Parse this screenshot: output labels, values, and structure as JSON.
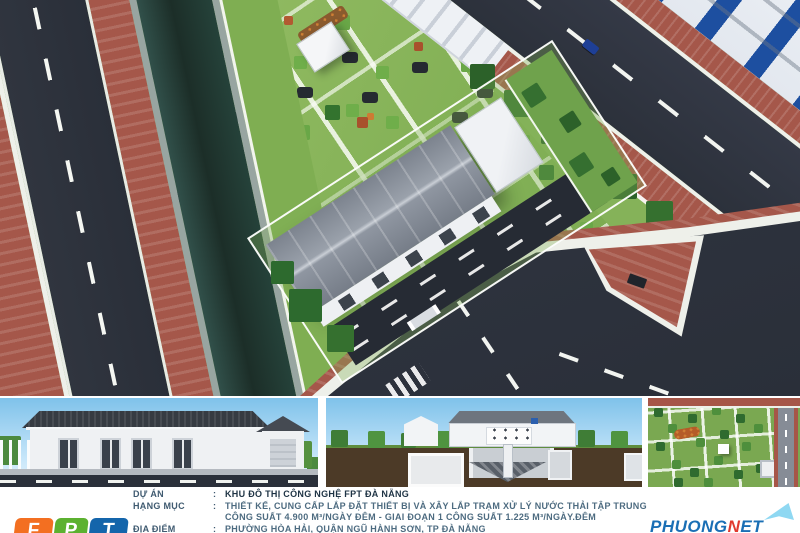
{
  "info": {
    "rows": [
      {
        "label": "DỰ ÁN",
        "colon": ":",
        "value": "KHU ĐÔ THỊ CÔNG NGHỆ FPT ĐÀ NẴNG"
      },
      {
        "label": "HẠNG MỤC",
        "colon": ":",
        "value": "THIẾT KẾ, CUNG CẤP LẮP ĐẶT THIẾT BỊ VÀ XÂY LẮP TRẠM XỬ LÝ NƯỚC THẢI TẬP TRUNG"
      },
      {
        "label": "",
        "colon": "",
        "value": "CÔNG SUẤT 4.900 M³/NGÀY ĐÊM - GIAI ĐOẠN 1 CÔNG SUẤT 1.225 M³/NGÀY.ĐÊM"
      },
      {
        "label": "ĐỊA ĐIỂM",
        "colon": ":",
        "value": "PHƯỜNG HÒA HẢI, QUẬN NGŨ HÀNH SƠN, TP ĐÀ NẴNG"
      }
    ]
  },
  "logos": {
    "fpt": {
      "letters": [
        "F",
        "P",
        "T"
      ],
      "tile_colors": [
        "#F36F21",
        "#5CB130",
        "#1465AB"
      ]
    },
    "partner": {
      "segments": [
        {
          "text": "PHUONG",
          "color": "#1A6FB5"
        },
        {
          "text": "N",
          "color": "#E03A2F"
        },
        {
          "text": "ET",
          "color": "#1A6FB5"
        }
      ]
    }
  },
  "colors": {
    "asphalt": "#2C313B",
    "brick_sidewalk": "#A5574A",
    "park_green": "#85B259",
    "canal_water": "#22362F",
    "factory_window_blue": "#1D4FA0",
    "sky": "#7FC2EA",
    "earth_brown": "#4C3A27",
    "info_text": "#4D6B80",
    "info_title": "#1E3344"
  }
}
